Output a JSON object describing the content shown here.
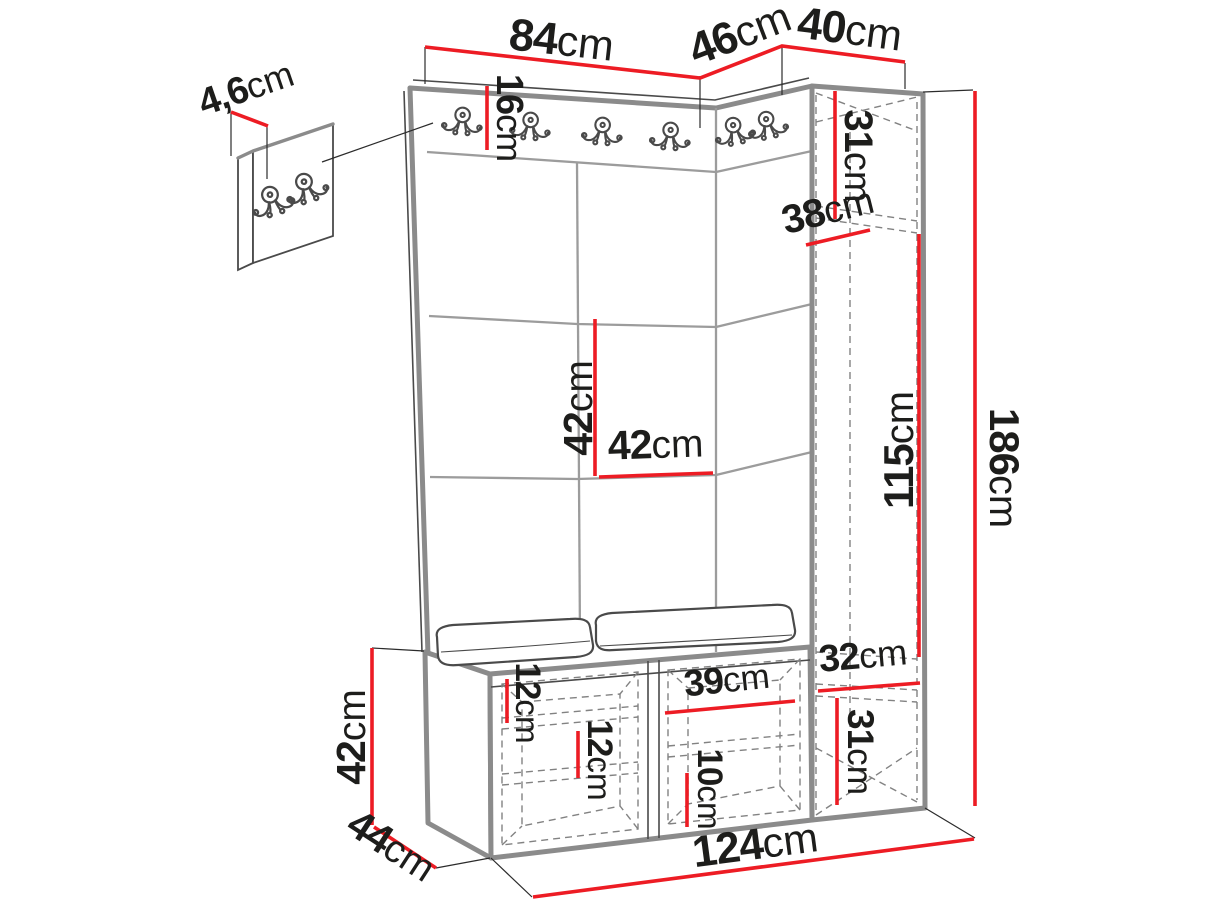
{
  "title": "Hallway furniture set dimension diagram",
  "colors": {
    "dimension_line": "#ed1c24",
    "label_text": "#1d1d1b",
    "furniture_outline": "#8b8b8b",
    "interior_dashed": "#828282",
    "background": "#ffffff"
  },
  "icons": {
    "coat_hook": "double-prong-coat-hook"
  },
  "dims": {
    "top_main": {
      "v": "84",
      "u": "cm"
    },
    "top_corner": {
      "v": "46",
      "u": "cm"
    },
    "top_cabinet": {
      "v": "40",
      "u": "cm"
    },
    "hook_panel_thickness": {
      "v": "4,6",
      "u": "cm"
    },
    "hook_rail_height": {
      "v": "16",
      "u": "cm"
    },
    "cabinet_top_niche": {
      "v": "31",
      "u": "cm"
    },
    "cabinet_depth": {
      "v": "38",
      "u": "cm"
    },
    "panel_tile_height": {
      "v": "42",
      "u": "cm"
    },
    "panel_tile_width": {
      "v": "42",
      "u": "cm"
    },
    "wardrobe_inner_height": {
      "v": "115",
      "u": "cm"
    },
    "total_height": {
      "v": "186",
      "u": "cm"
    },
    "cabinet_shelf_depth": {
      "v": "32",
      "u": "cm"
    },
    "cabinet_bottom_niche": {
      "v": "31",
      "u": "cm"
    },
    "bench_upper_shelf": {
      "v": "12",
      "u": "cm"
    },
    "bench_lower_shelf": {
      "v": "12",
      "u": "cm"
    },
    "bench_compartment_width": {
      "v": "39",
      "u": "cm"
    },
    "bench_bottom_gap": {
      "v": "10",
      "u": "cm"
    },
    "bench_height": {
      "v": "42",
      "u": "cm"
    },
    "bench_depth": {
      "v": "44",
      "u": "cm"
    },
    "total_width": {
      "v": "124",
      "u": "cm"
    }
  }
}
